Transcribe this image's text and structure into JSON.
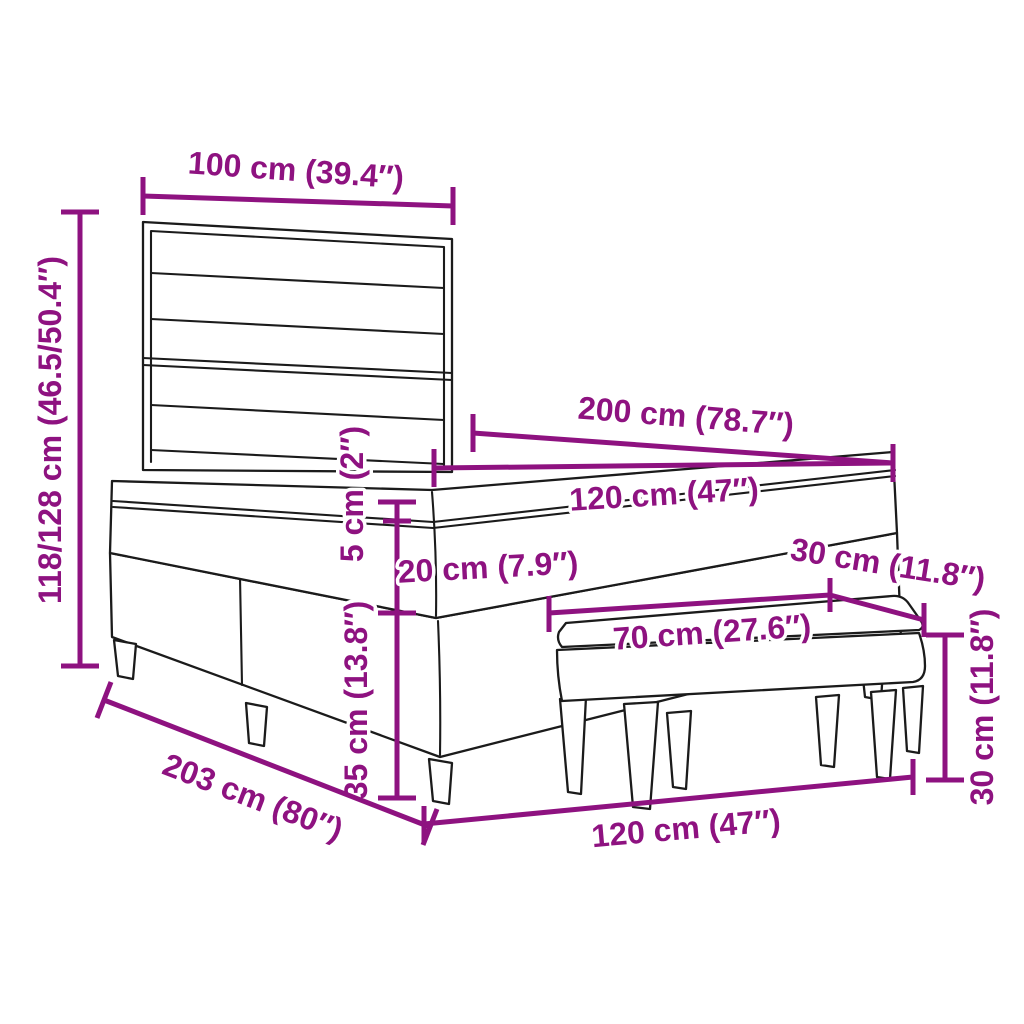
{
  "diagram": {
    "subject": "Box spring bed with slatted headboard, mattress with topper, and upholstered bench",
    "style": "technical line drawing with dimension callouts"
  },
  "colors": {
    "dimension_accent": "#8e1280",
    "line_art": "#1b1b1b",
    "background": "#ffffff"
  },
  "dimensions": {
    "headboard_width": {
      "label": "100 cm (39.4″)"
    },
    "overall_height": {
      "label": "118/128 cm (46.5/50.4″)"
    },
    "bed_length": {
      "label": "200 cm (78.7″)"
    },
    "mattress_width_top": {
      "label": "120 cm (47″)"
    },
    "topper_thickness": {
      "label": "5 cm (2″)"
    },
    "mattress_thickness": {
      "label": "20 cm (7.9″)"
    },
    "base_height": {
      "label": "35 cm (13.8″)"
    },
    "bench_depth": {
      "label": "30 cm (11.8″)"
    },
    "bench_width": {
      "label": "70 cm (27.6″)"
    },
    "bench_height": {
      "label": "30 cm (11.8″)"
    },
    "frame_length": {
      "label": "203 cm (80″)"
    },
    "bed_width_bottom": {
      "label": "120 cm (47″)"
    }
  }
}
